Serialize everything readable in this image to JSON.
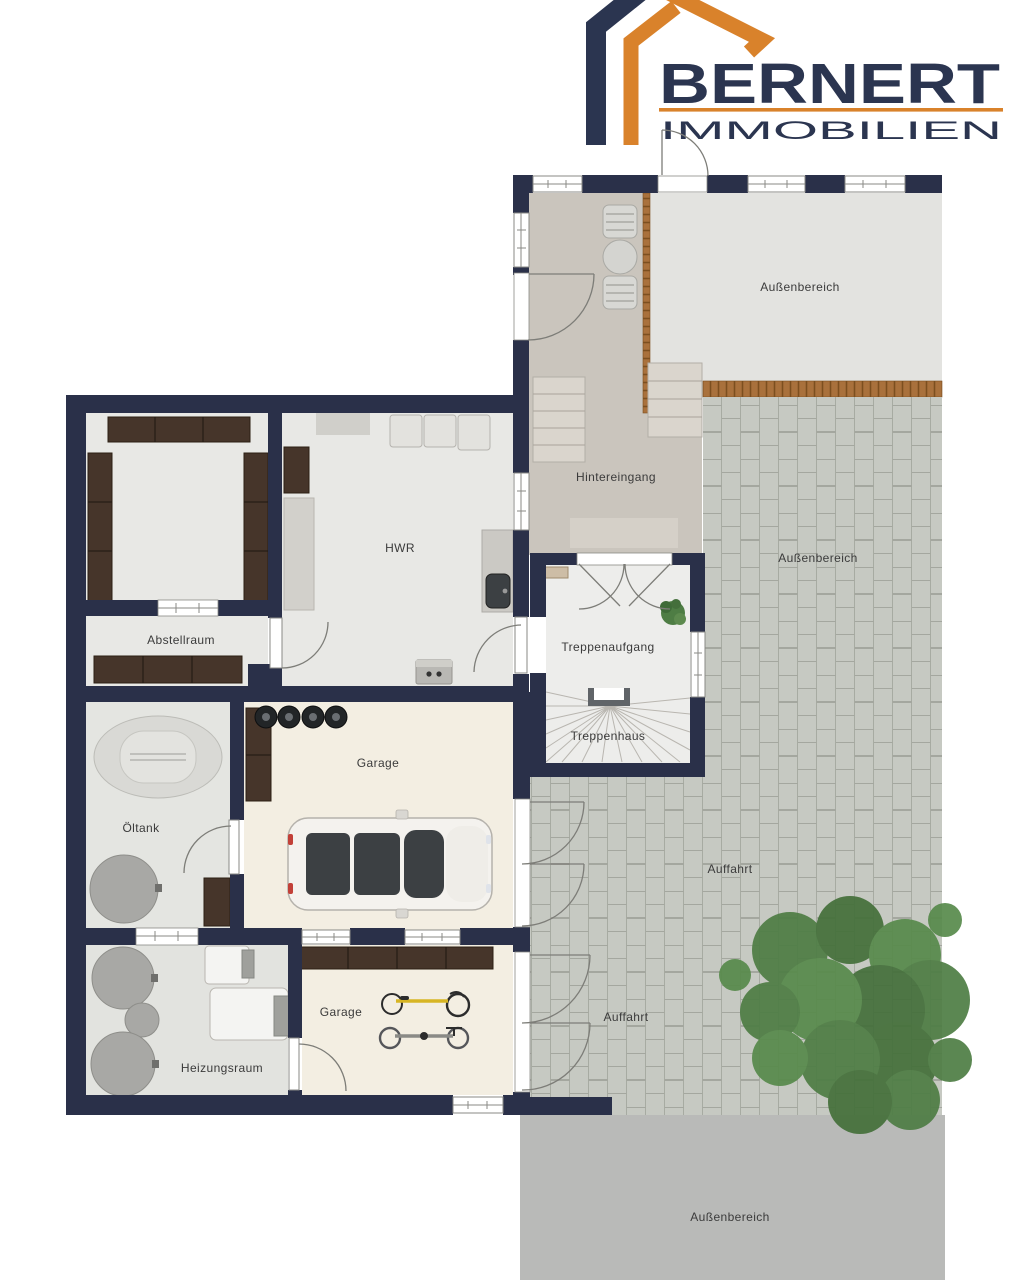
{
  "brand": {
    "name": "BERNERT",
    "subtitle": "IMMOBILIEN"
  },
  "labels": {
    "aussenbereich_oben": "Außenbereich",
    "hintereingang": "Hintereingang",
    "aussenbereich_mitte": "Außenbereich",
    "treppenaufgang": "Treppenaufgang",
    "treppenhaus": "Treppenhaus",
    "hwr": "HWR",
    "abstellraum": "Abstellraum",
    "oeltank": "Öltank",
    "garage_oben": "Garage",
    "auffahrt_oben": "Auffahrt",
    "auffahrt_unten": "Auffahrt",
    "heizungsraum": "Heizungsraum",
    "garage_unten": "Garage",
    "aussenbereich_unten": "Außenbereich"
  },
  "colors": {
    "wall": "#2a3049",
    "brand_navy": "#2b3550",
    "brand_orange": "#d9822b",
    "room_floor": "#e8e8e5",
    "garage_floor": "#f3eee2",
    "terrace_floor": "#cac5bd",
    "outdoor_light": "#e3e3e0",
    "outdoor_gray": "#b9bab8",
    "paving": "#c6c9c2",
    "paving_joint": "#989c93",
    "wood": "#a9713c",
    "shelf_brown": "#46352a",
    "stair_tread": "#dad5cd",
    "tank_gray": "#a8a8a5",
    "appliance_gray": "#e3e2de",
    "counter_gray": "#cbc9c4",
    "car_body": "#f4f2ee",
    "glass_dark": "#3c4043",
    "tree_green": "#4e7d44",
    "bike_yellow": "#d7b524",
    "label": "#3b3b3b",
    "line": "#8a8a86"
  }
}
